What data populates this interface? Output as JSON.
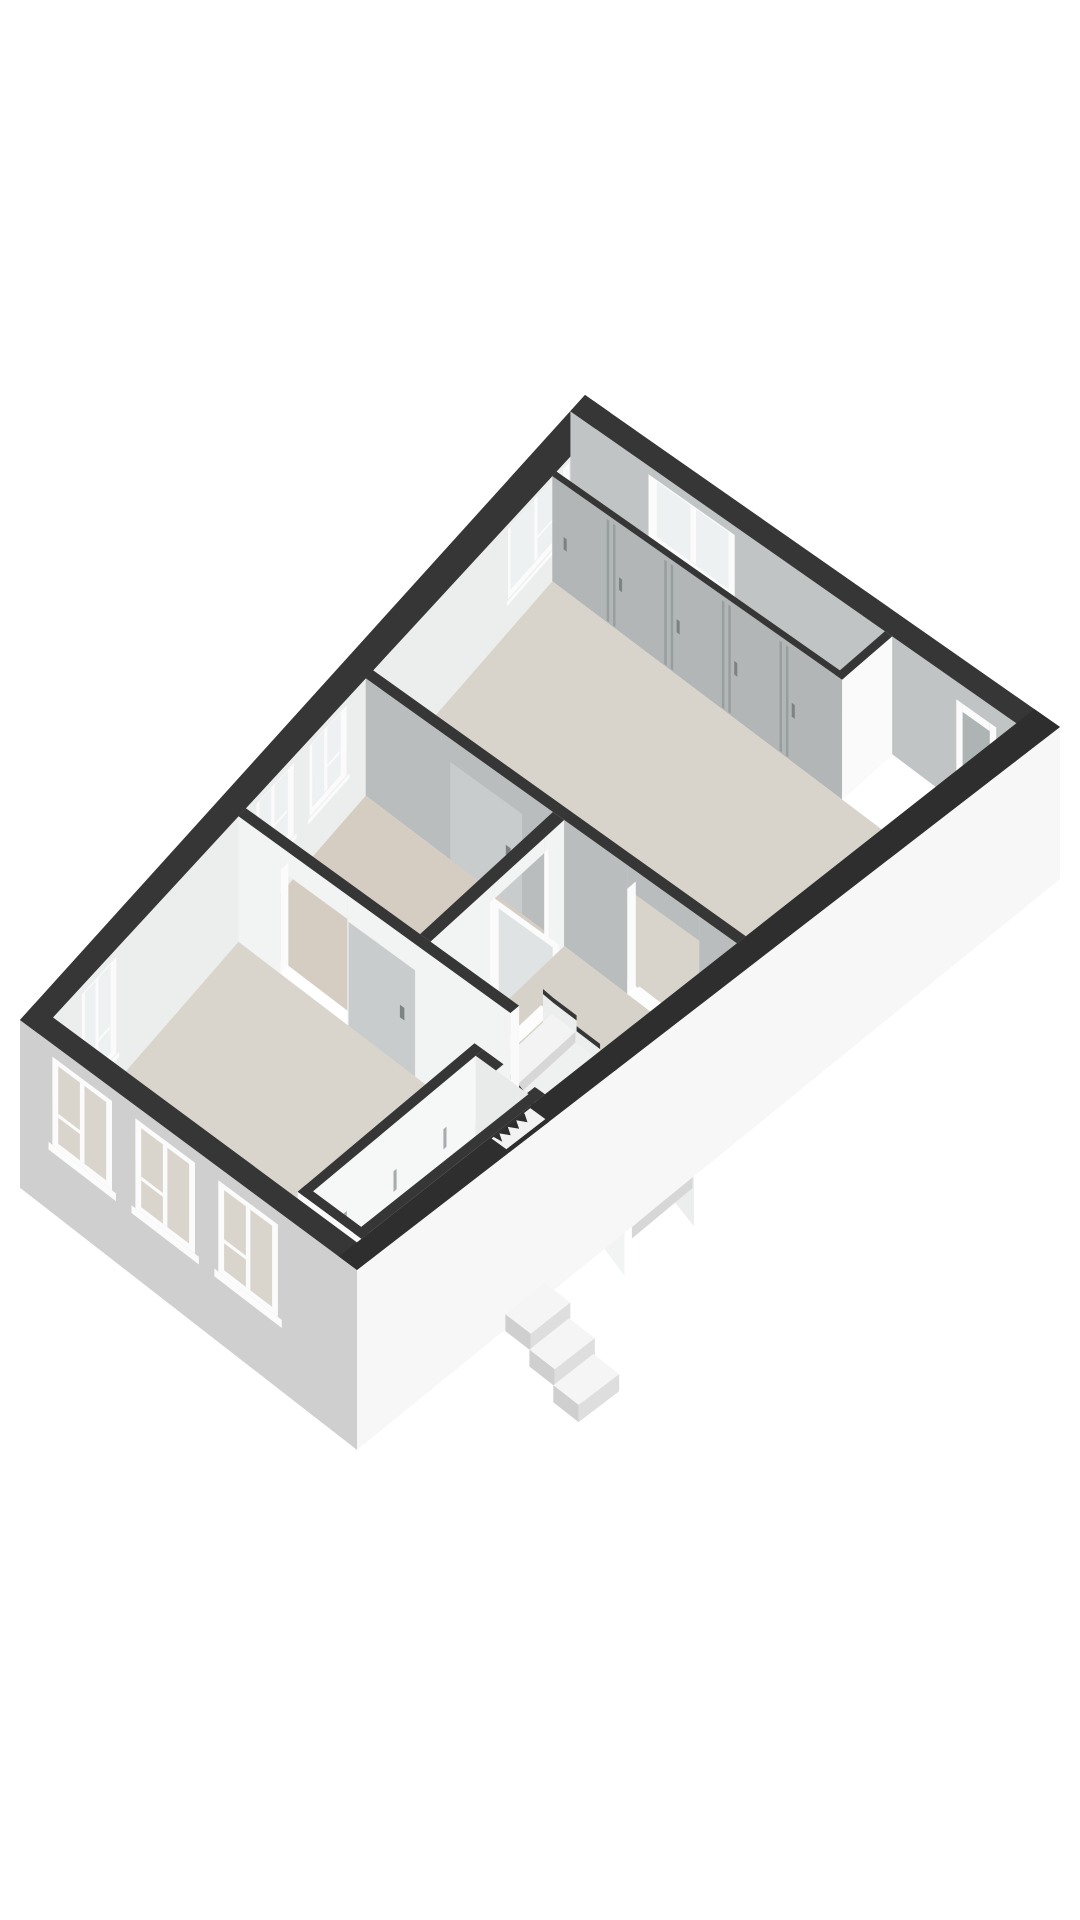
{
  "page": {
    "kind": "3d-floor-plan-render",
    "background": "#ffffff"
  },
  "colors": {
    "bg": "#ffffff",
    "wallTop": "#363636",
    "wallTopFront": "#2e2e2e",
    "nwFace": "#eceeee",
    "neFace": "#c0c4c4",
    "wardrobeFace": "#b2b6b6",
    "seam": "#989e9e",
    "handle": "#7d8383",
    "capWhite": "#fafafa",
    "floorBedroom": "#d8d4cb",
    "floorBath": "#d5cdc2",
    "floorHall": "#d6d2c9",
    "floorLiving": "#d9d5cc",
    "floorBox": "#eceae5",
    "floorStrip": "#e3e1dc",
    "intWallWhite": "#f2f3f3",
    "intWallGray": "#b9bdbd",
    "doorLeaf": "#c8cccc",
    "frame": "#fbfbfb",
    "glass": "#eef1f1",
    "glassDoor": "#dfe3e3",
    "swFace": "#cfcfcf",
    "swGlass": "#d9d5cd",
    "seFace": "#f7f7f7",
    "tread": "#f3f3f3",
    "treadAlt": "#eff0f0",
    "riser": "#d7d7d7",
    "stringer": "#eceeee",
    "stepTop": "#f5f5f5",
    "stepFront": "#dedede",
    "stepSide": "#cfcfcf",
    "threshold": "#fdfdfd",
    "recess": "#aeb4b4",
    "boxInner": "#f6f7f7",
    "boxInnerEnd": "#e9ebeb",
    "tick": "#a7adad"
  },
  "scene": {
    "view": "axonometric-top-down",
    "rooms": [
      {
        "name": "bedroom",
        "floor": "beige"
      },
      {
        "name": "bathroom",
        "floor": "beige"
      },
      {
        "name": "landing-hall",
        "floor": "beige"
      },
      {
        "name": "living-room",
        "floor": "beige"
      },
      {
        "name": "wardrobe-strip",
        "doors": 5
      },
      {
        "name": "storage-closet"
      }
    ],
    "features": {
      "nw-wall-windows": 4,
      "ne-wall-windows": 1,
      "ne-wall-door-frames": 1,
      "sw-wall-windows": 3,
      "stair-treads-visible": 6,
      "entrance-steps": 3,
      "open-glass-door": 1,
      "interior-door-leaves": 2
    }
  }
}
